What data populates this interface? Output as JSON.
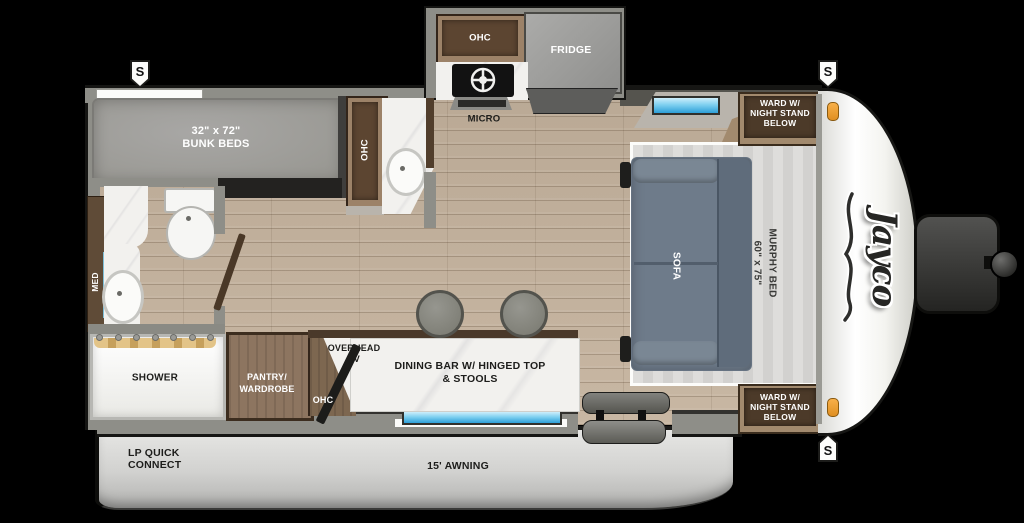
{
  "brand": {
    "logo_text": "Jayco"
  },
  "markers": {
    "stabilizer": "S"
  },
  "bunk_room": {
    "size": "32\" x 72\"",
    "label": "BUNK BEDS",
    "ohc": "OHC"
  },
  "bathroom": {
    "med": "MED",
    "shower": "SHOWER"
  },
  "kitchen": {
    "ohc": "OHC",
    "fridge": "FRIDGE",
    "micro": "MICRO"
  },
  "galley": {
    "pantry_line1": "PANTRY/",
    "pantry_line2": "WARDROBE",
    "ohc": "OHC",
    "tv_line1": "OVERHEAD",
    "tv_line2": "TV",
    "dining_line1": "DINING BAR W/ HINGED TOP",
    "dining_line2": "& STOOLS"
  },
  "living": {
    "sofa": "SOFA",
    "murphy_size": "60\" x 75\"",
    "murphy_label": "MURPHY BED"
  },
  "wardrobe": {
    "line1": "WARD W/",
    "line2": "NIGHT STAND",
    "line3": "BELOW"
  },
  "exterior": {
    "lp_line1": "LP QUICK",
    "lp_line2": "CONNECT",
    "awning": "15' AWNING"
  },
  "colors": {
    "floor_wood": "#c3b29e",
    "cabinet_wood": "#8d7560",
    "dark_wood": "#4c3a29",
    "sofa": "#6e7b8a",
    "marble": "#f2f1ee",
    "window_blue": "#5ec0e8",
    "awning_gray": "#d6d6d4",
    "marker_orange": "#f2a43c",
    "wall_gray": "#8e8e88",
    "mattress_gray": "#a09f9d"
  }
}
